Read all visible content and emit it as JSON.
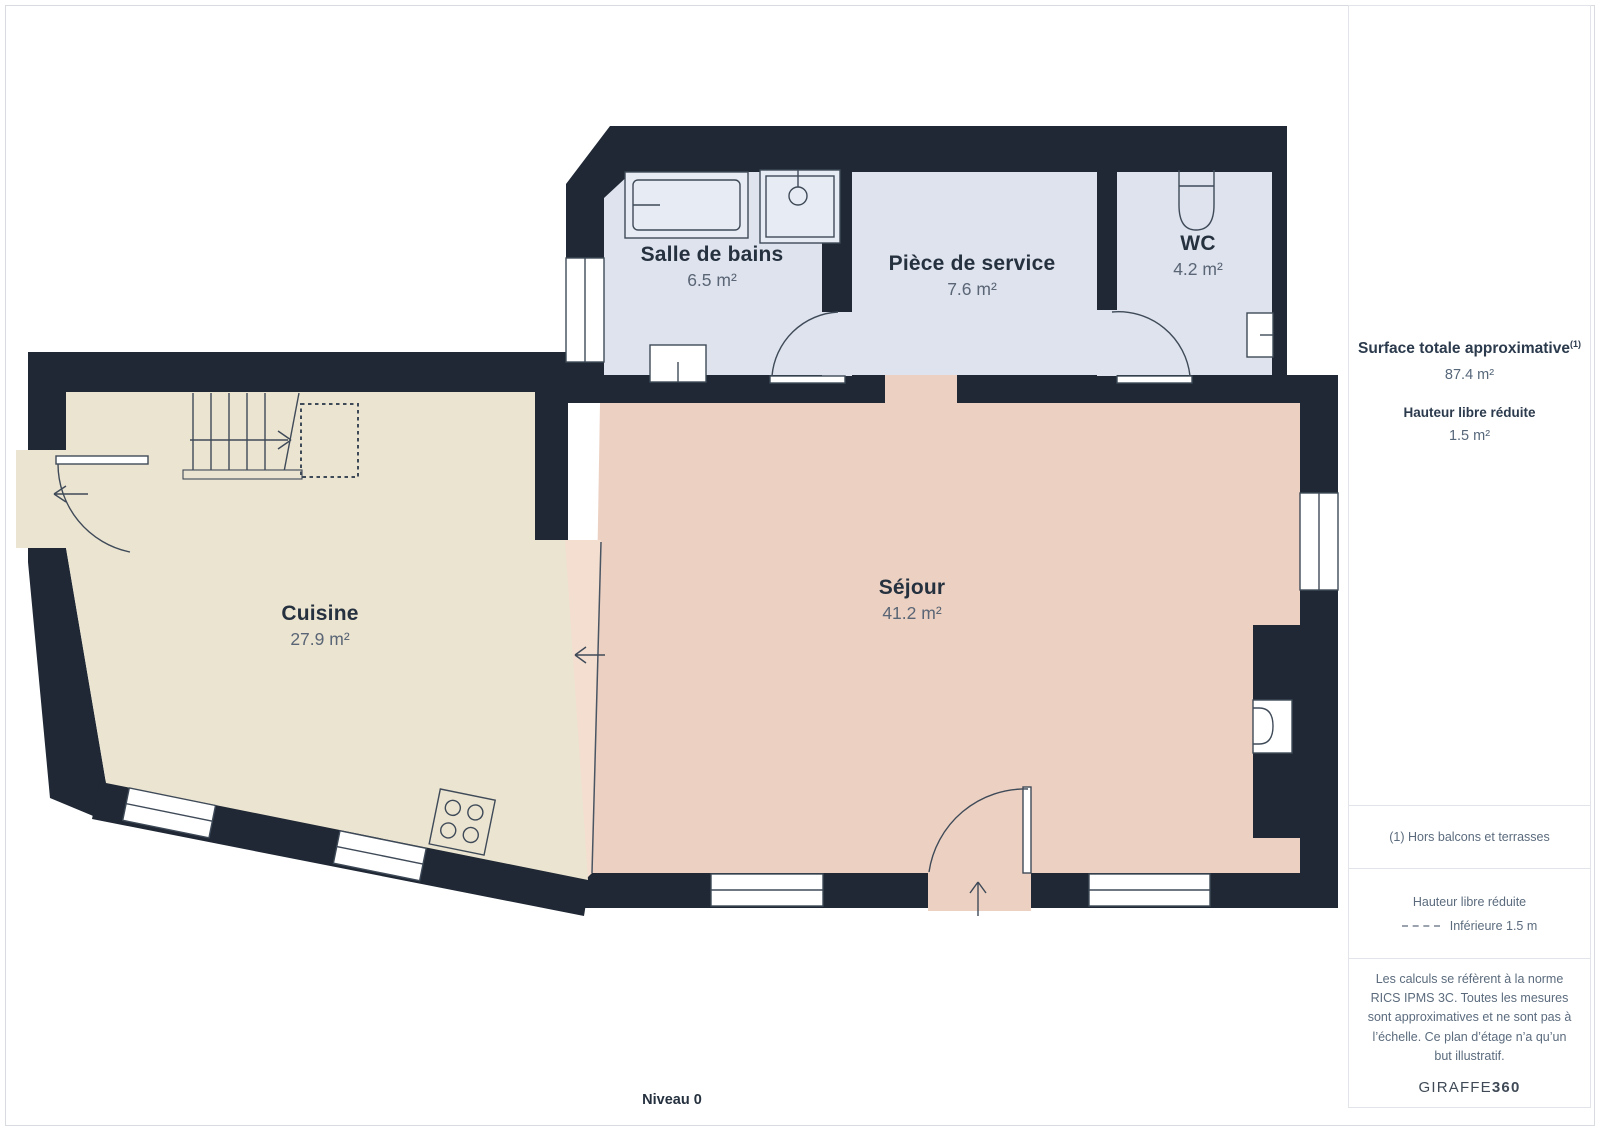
{
  "plan": {
    "level_label": "Niveau 0",
    "rooms": [
      {
        "name": "Salle de bains",
        "area": "6.5 m²"
      },
      {
        "name": "Pièce de service",
        "area": "7.6 m²"
      },
      {
        "name": "WC",
        "area": "4.2 m²"
      },
      {
        "name": "Cuisine",
        "area": "27.9 m²"
      },
      {
        "name": "Séjour",
        "area": "41.2 m²"
      }
    ],
    "colors": {
      "wall": "#1f2834",
      "wet_room_fill": "#dee3ee",
      "kitchen_fill": "#ebe4d1",
      "living_fill": "#ecd1c2",
      "reduced_height_fill": "#f3decf",
      "line": "#3f4a58"
    }
  },
  "sidebar": {
    "total_label": "Surface totale approximative",
    "total_superscript": "(1)",
    "total_value": "87.4 m²",
    "reduced_label": "Hauteur libre réduite",
    "reduced_value": "1.5 m²",
    "footnote": "(1) Hors balcons et terrasses",
    "legend_title": "Hauteur libre réduite",
    "legend_item": "Inférieure 1.5 m",
    "disclaimer": "Les calculs se réfèrent à la norme RICS IPMS 3C. Toutes les mesures sont approximatives et ne sont pas à l’échelle. Ce plan d’étage n’a qu’un but illustratif.",
    "brand_name": "GIRAFFE",
    "brand_suffix": "360"
  }
}
